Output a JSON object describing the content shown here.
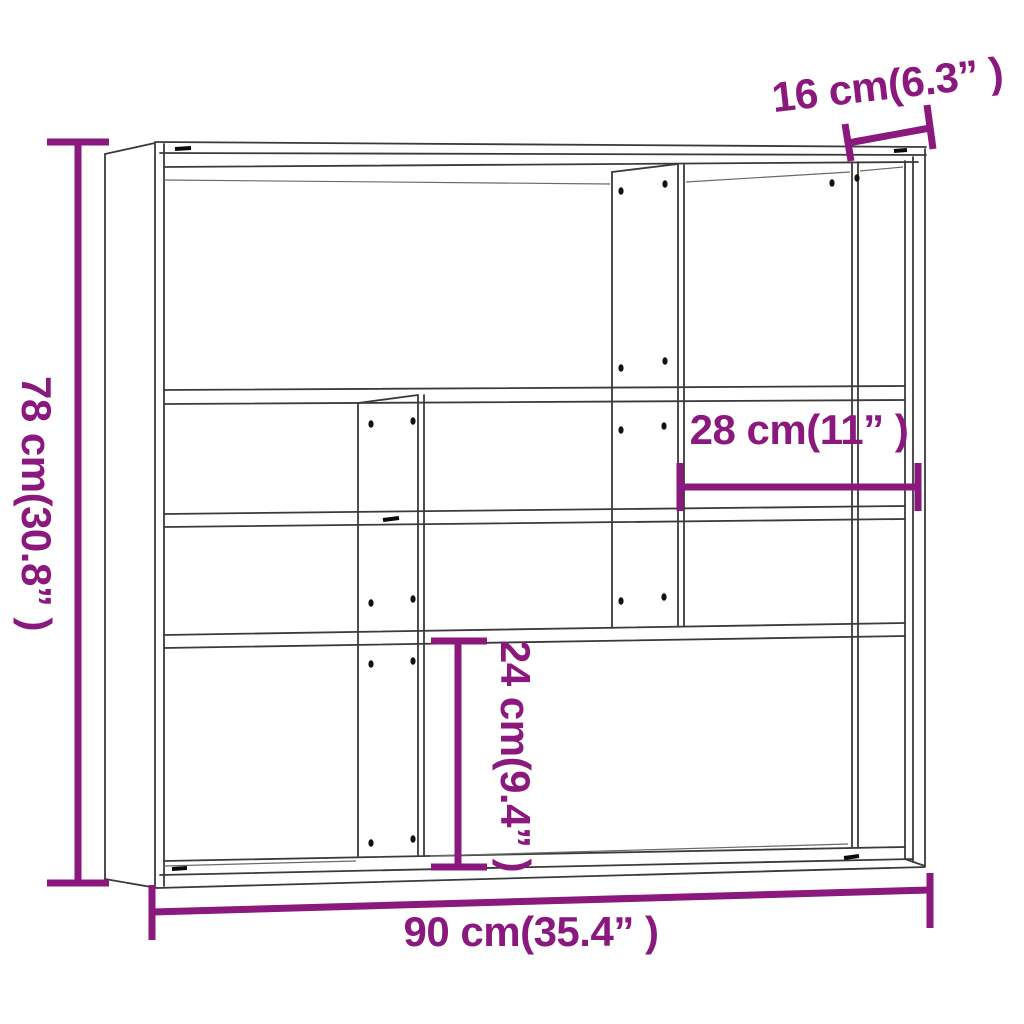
{
  "diagram": {
    "type": "furniture-dimension-diagram",
    "product": "Wall shelf with compartments",
    "background_color": "#ffffff",
    "outline_color": "#3a3a3a",
    "dimension_color": "#8A187D",
    "dimensions": {
      "overall_height": {
        "label": "78 cm(30.8” )",
        "cm": 78,
        "inch": "30.8"
      },
      "top_right_column_width": {
        "label": "16 cm(6.3” )",
        "cm": 16,
        "inch": "6.3"
      },
      "right_compartment_width": {
        "label": "28 cm(11” )",
        "cm": 28,
        "inch": "11"
      },
      "bottom_compartment_height": {
        "label": "24 cm(9.4” )",
        "cm": 24,
        "inch": "9.4"
      },
      "overall_width": {
        "label": "90 cm(35.4” )",
        "cm": 90,
        "inch": "35.4"
      }
    }
  }
}
